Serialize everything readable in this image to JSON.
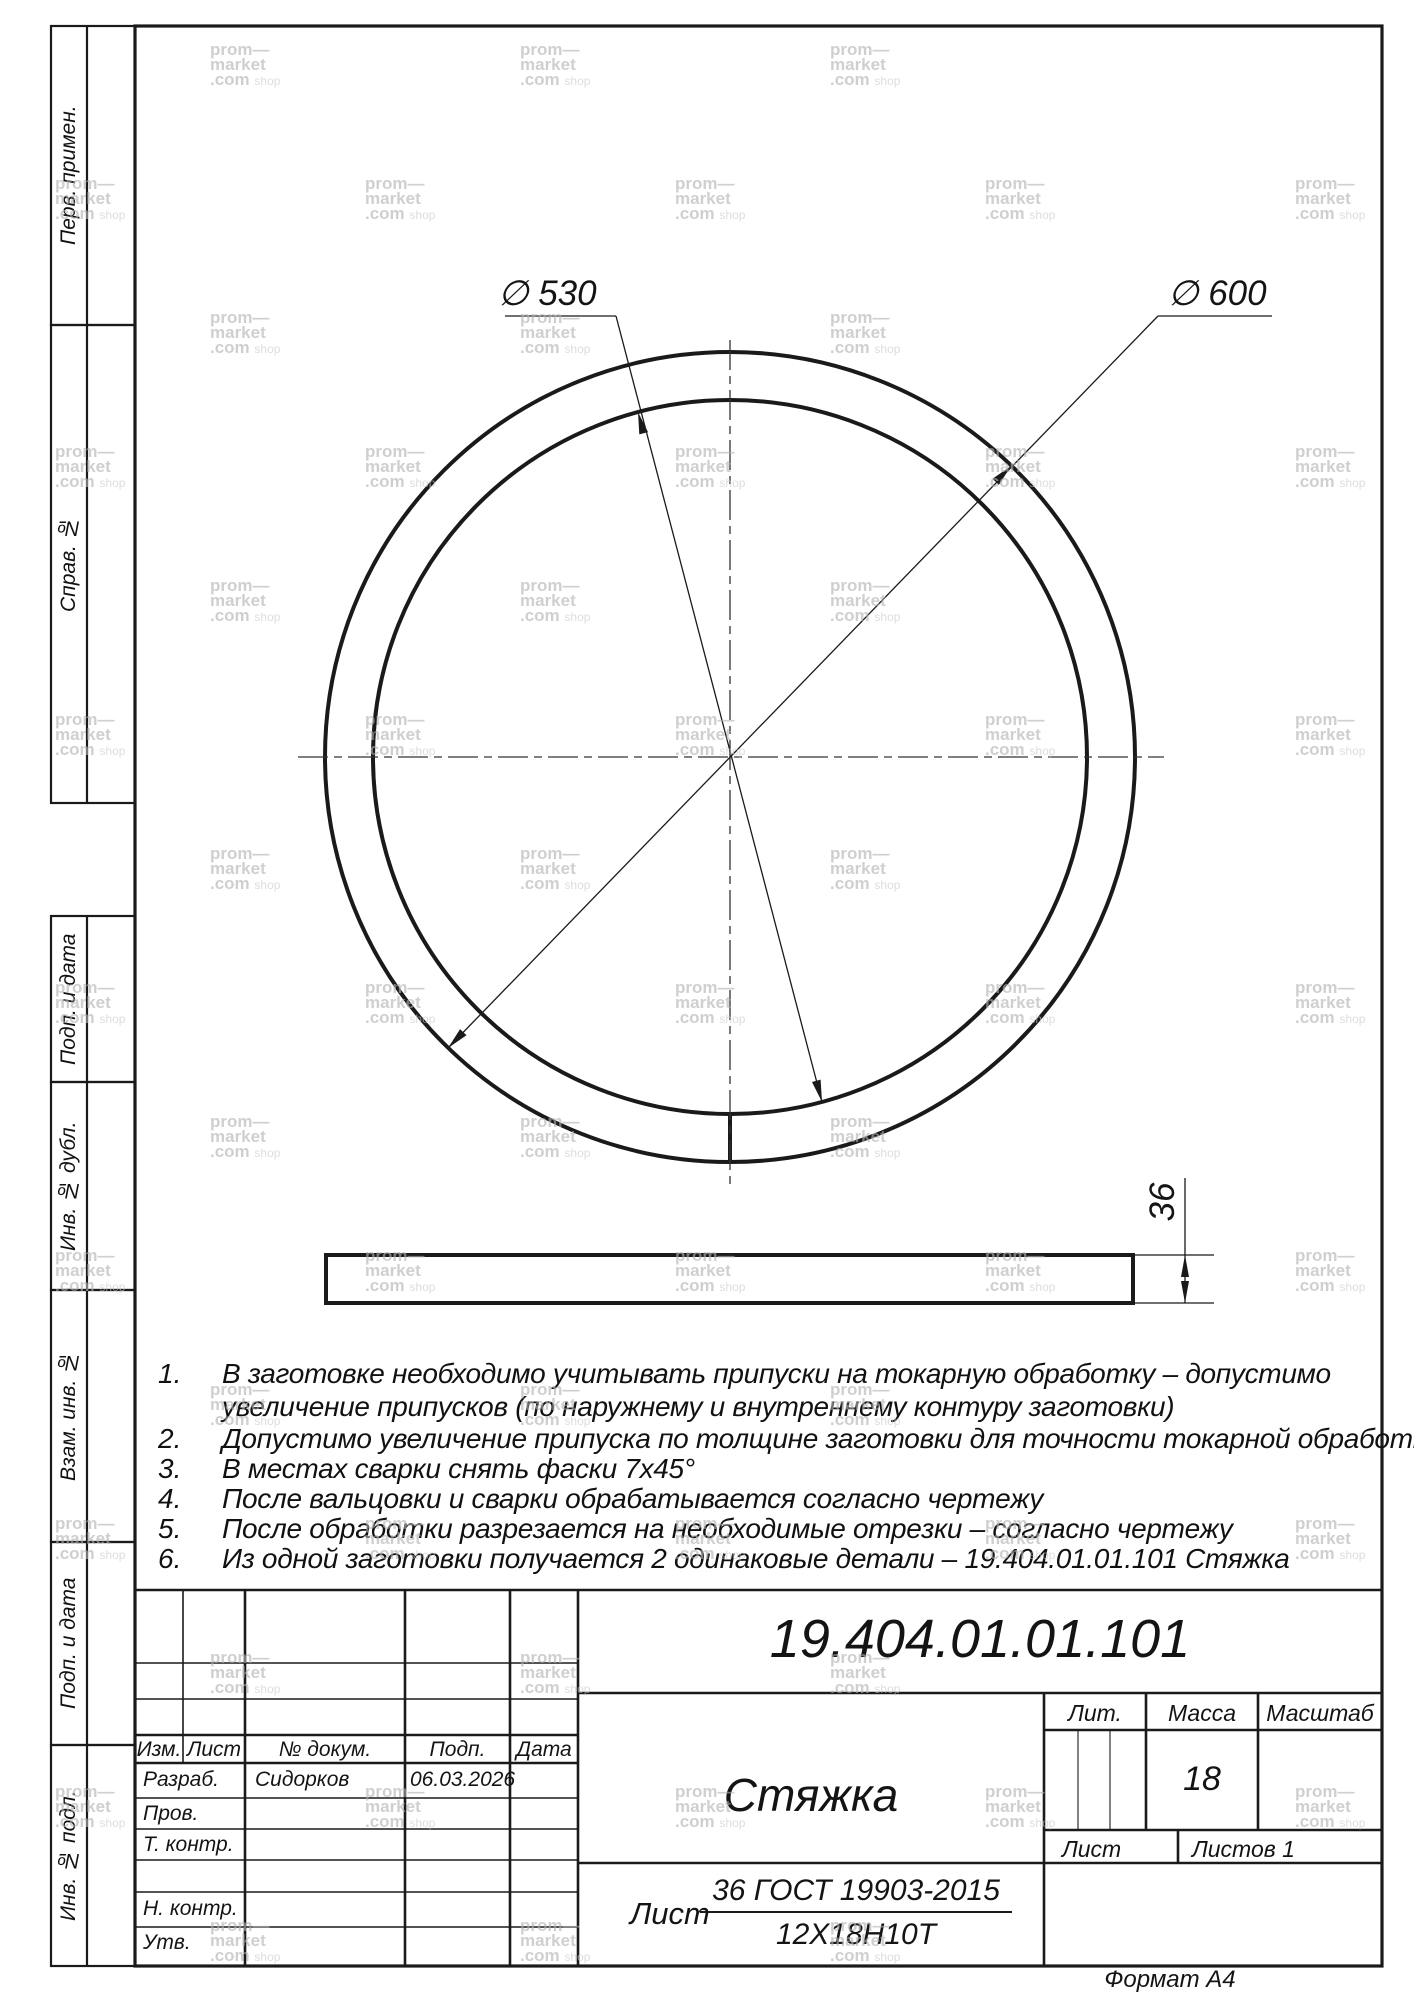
{
  "colors": {
    "line": "#1a1a1a",
    "watermark": "#b3b3b3"
  },
  "watermark": {
    "l1": "prom—",
    "l2": "market",
    "l3": ".com",
    "l3b": "shop"
  },
  "margin": {
    "boxes": [
      {
        "label": "Перв. примен."
      },
      {
        "label": "Справ. №"
      },
      {
        "label": "Подп. и дата"
      },
      {
        "label": "Инв. № дубл."
      },
      {
        "label": "Взам. инв. №"
      },
      {
        "label": "Подп. и дата"
      },
      {
        "label": "Инв. № подл."
      }
    ]
  },
  "drawing": {
    "dia_inner": "∅ 530",
    "dia_outer": "∅ 600",
    "thickness": "36"
  },
  "notes": [
    {
      "num": "1.",
      "lines": [
        "В заготовке необходимо учитывать припуски на токарную обработку – допустимо",
        "увеличение припусков (по наружнему и внутреннему контуру заготовки)"
      ]
    },
    {
      "num": "2.",
      "lines": [
        "Допустимо увеличение припуска по толщине заготовки для точности токарной обработки"
      ]
    },
    {
      "num": "3.",
      "lines": [
        "В местах сварки снять фаски 7х45°"
      ]
    },
    {
      "num": "4.",
      "lines": [
        "После вальцовки и сварки обрабатывается согласно чертежу"
      ]
    },
    {
      "num": "5.",
      "lines": [
        "После обработки разрезается на необходимые отрезки – согласно чертежу"
      ]
    },
    {
      "num": "6.",
      "lines": [
        "Из одной заготовки получается 2 одинаковые детали –  19.404.01.01.101 Стяжка"
      ]
    }
  ],
  "title_block": {
    "doc_number": "19.404.01.01.101",
    "part_name": "Стяжка",
    "header": {
      "izm": "Изм.",
      "list": "Лист",
      "doc": "№ докум.",
      "podp": "Подп.",
      "data": "Дата"
    },
    "rows": {
      "razrab": "Разраб.",
      "prov": "Пров.",
      "tkontr": "Т. контр.",
      "nkontr": "Н. контр.",
      "utv": "Утв."
    },
    "razrab_name": "Сидорков",
    "razrab_date": "06.03.2026",
    "lit_label": "Лит.",
    "massa_label": "Масса",
    "masshtab_label": "Масштаб",
    "massa_value": "18",
    "list_label": "Лист",
    "listov_label": "Листов",
    "listov_value": "1",
    "material": {
      "prefix": "Лист",
      "numerator": "36 ГОСТ 19903-2015",
      "denominator": "12Х18Н10Т"
    },
    "format_note": "Формат А4"
  }
}
